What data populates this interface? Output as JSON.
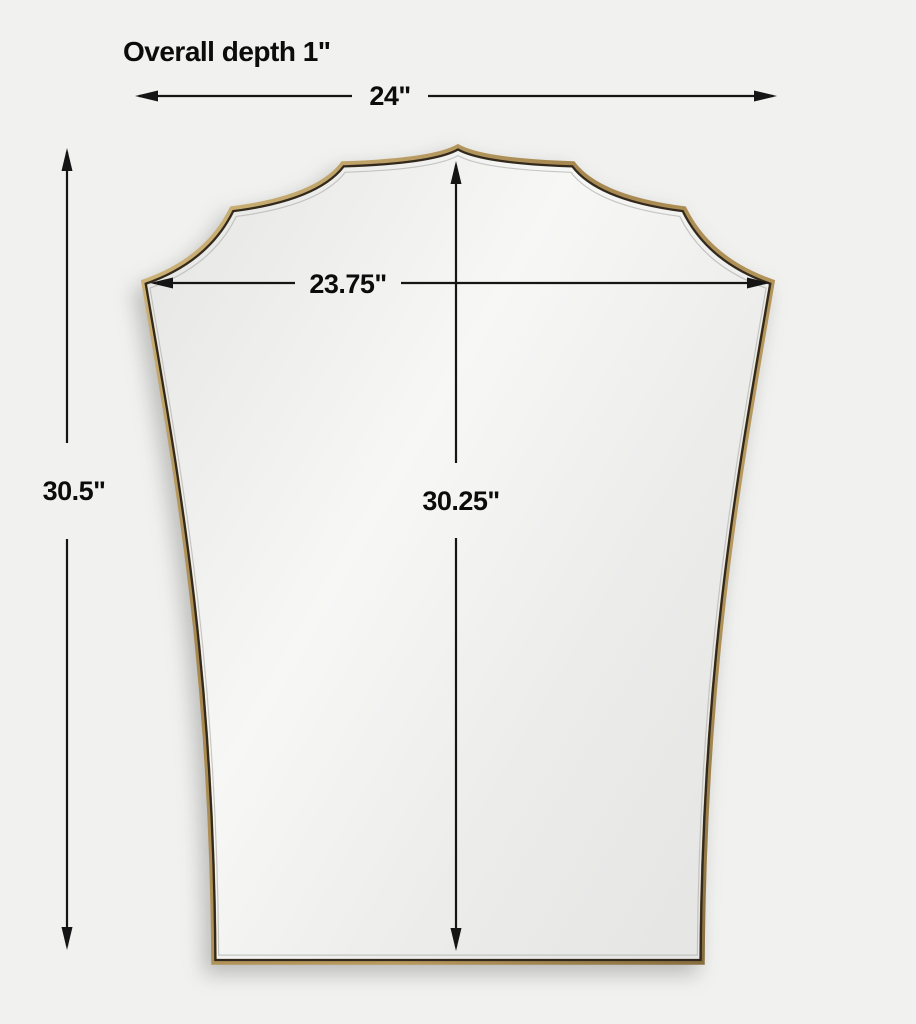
{
  "diagram": {
    "title": "Overall depth 1\"",
    "subject": "scalloped-crown mirror with thin brass frame",
    "dimensions": {
      "overall_width": "24\"",
      "overall_height": "30.5\"",
      "mirror_width": "23.75\"",
      "mirror_height": "30.25\"",
      "overall_depth": "1\""
    },
    "colors": {
      "background": "#f1f1ef",
      "dimension_line": "#151515",
      "label_text": "#0c0c0c",
      "frame_gold": "#a5874f",
      "frame_gold_highlight": "#d9bf83",
      "frame_gold_shadow": "#7c6437",
      "frame_inner_dark": "#32291c",
      "glass_light": "#f7f7f6",
      "glass_dark": "#e2e2e1",
      "bevel_line": "#b5b5b3"
    }
  }
}
